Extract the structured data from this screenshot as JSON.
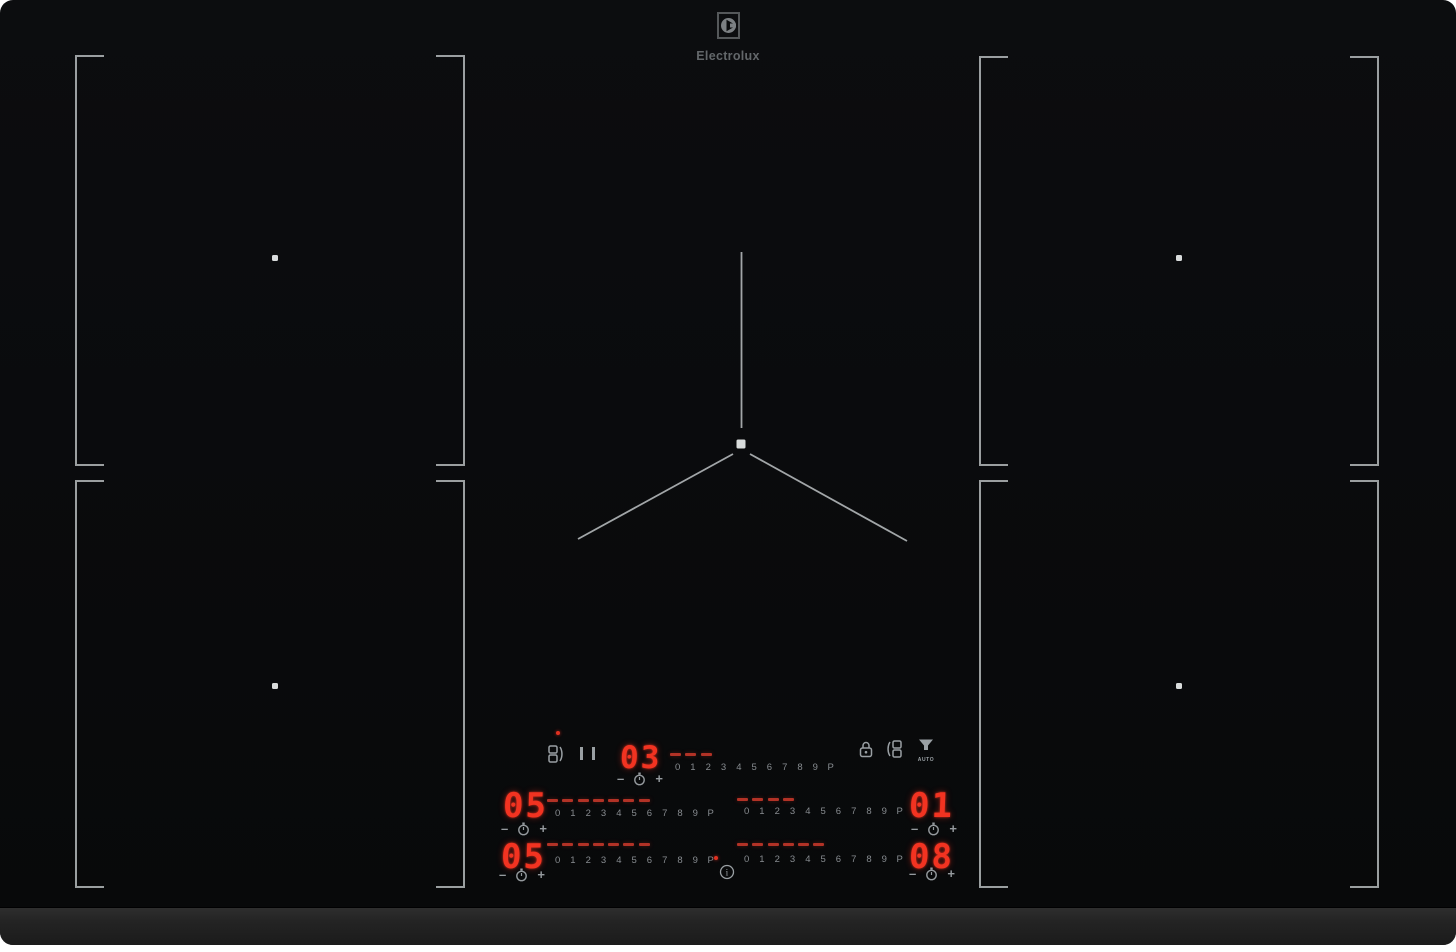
{
  "brand": {
    "name": "Electrolux"
  },
  "controls": {
    "numbers": [
      "0",
      "1",
      "2",
      "3",
      "4",
      "5",
      "6",
      "7",
      "8",
      "9",
      "P"
    ],
    "minus": "–",
    "plus": "+",
    "auto_label": "AUTO",
    "info_glyph": "i",
    "displays": {
      "center": "03",
      "mid_left": "05",
      "mid_right": "01",
      "bottom_left": "05",
      "bottom_right": "08"
    },
    "levels": {
      "center": 3,
      "mid_left": 7,
      "mid_right": 4,
      "bottom_left": 7,
      "bottom_right": 6
    },
    "icons": [
      "bridge-left",
      "pause",
      "lock",
      "bridge-right",
      "hood-auto",
      "timer-clock",
      "info"
    ]
  },
  "colors": {
    "led_red": "#f23321",
    "dash_red": "#b23226",
    "label_gray": "#878c90",
    "icon_gray": "#9aa0a4",
    "zone_line": "#c4c9cb"
  }
}
